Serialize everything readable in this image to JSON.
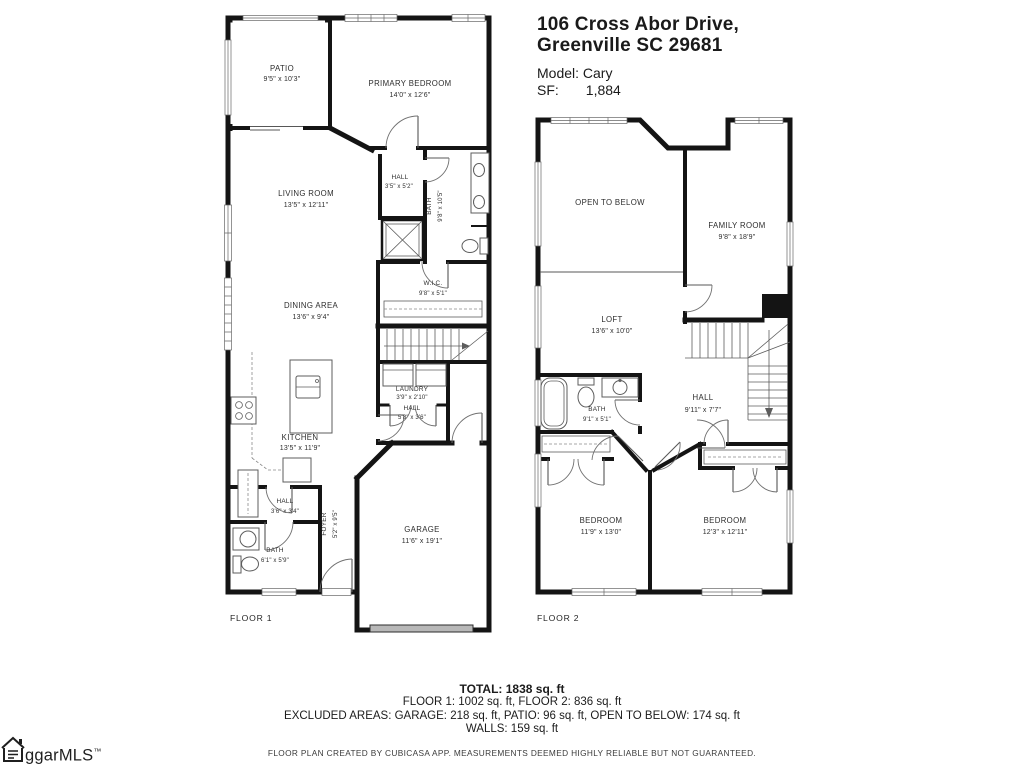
{
  "header": {
    "address_line1": "106 Cross Abor Drive,",
    "address_line2": "Greenville SC 29681",
    "model_label": "Model: Cary",
    "sf_label": "SF:",
    "sf_value": "1,884"
  },
  "floor1": {
    "label": "FLOOR 1",
    "rooms": {
      "patio": {
        "name": "PATIO",
        "dims": "9'5\" x 10'3\""
      },
      "primary_bedroom": {
        "name": "PRIMARY BEDROOM",
        "dims": "14'0\" x 12'6\""
      },
      "living_room": {
        "name": "LIVING ROOM",
        "dims": "13'5\" x 12'11\""
      },
      "hall_upper": {
        "name": "HALL",
        "dims": "3'5\" x 5'2\""
      },
      "bath_upper": {
        "name": "BATH",
        "dims": "9'8\" x 10'5\""
      },
      "wic": {
        "name": "W.I.C.",
        "dims": "9'8\" x 5'1\""
      },
      "dining_area": {
        "name": "DINING AREA",
        "dims": "13'6\" x 9'4\""
      },
      "laundry": {
        "name": "LAUNDRY",
        "dims": "3'9\" x 2'10\""
      },
      "hall_mid": {
        "name": "HALL",
        "dims": "5'8\" x 3'6\""
      },
      "kitchen": {
        "name": "KITCHEN",
        "dims": "13'5\" x 11'9\""
      },
      "hall_lower": {
        "name": "HALL",
        "dims": "3'6\" x 3'4\""
      },
      "bath_lower": {
        "name": "BATH",
        "dims": "6'1\" x 5'9\""
      },
      "foyer": {
        "name": "FOYER",
        "dims": "5'2\" x 9'5\""
      },
      "garage": {
        "name": "GARAGE",
        "dims": "11'6\" x 19'1\""
      }
    }
  },
  "floor2": {
    "label": "FLOOR 2",
    "rooms": {
      "open_to_below": {
        "name": "OPEN TO BELOW"
      },
      "family_room": {
        "name": "FAMILY ROOM",
        "dims": "9'8\" x 18'9\""
      },
      "loft": {
        "name": "LOFT",
        "dims": "13'6\" x 10'0\""
      },
      "bath": {
        "name": "BATH",
        "dims": "9'1\" x 5'1\""
      },
      "hall": {
        "name": "HALL",
        "dims": "9'11\" x 7'7\""
      },
      "bedroom_left": {
        "name": "BEDROOM",
        "dims": "11'9\" x 13'0\""
      },
      "bedroom_right": {
        "name": "BEDROOM",
        "dims": "12'3\" x 12'11\""
      }
    }
  },
  "summary": {
    "total": "TOTAL: 1838 sq. ft",
    "floors": "FLOOR 1: 1002 sq. ft, FLOOR 2: 836 sq. ft",
    "excluded": "EXCLUDED AREAS: GARAGE: 218 sq. ft, PATIO: 96 sq. ft, OPEN TO BELOW: 174 sq. ft",
    "walls": "WALLS: 159 sq. ft",
    "disclaimer": "FLOOR PLAN CREATED BY CUBICASA APP. MEASUREMENTS DEEMED HIGHLY RELIABLE BUT NOT GUARANTEED."
  },
  "logo": {
    "name": "ggarMLS",
    "tm": "™"
  },
  "colors": {
    "wall": "#141414",
    "text": "#2d2d2d",
    "garage_door": "#b8b8b8"
  }
}
